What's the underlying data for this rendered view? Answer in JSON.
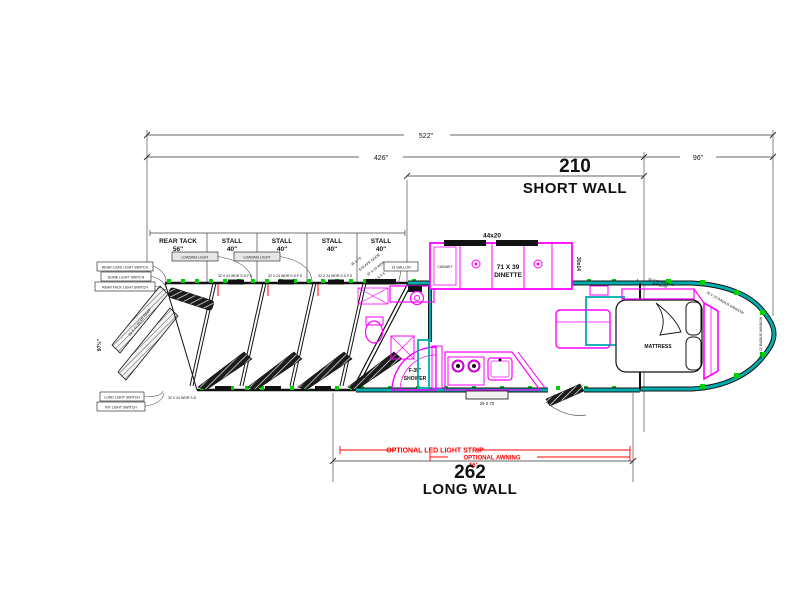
{
  "colors": {
    "line_black": "#111111",
    "furniture_magenta": "#ff00ff",
    "wall_teal": "#00adad",
    "marker_green": "#00d000",
    "option_red": "#ff0000"
  },
  "dimensions": {
    "overall": "522\"",
    "horse_section": "426\"",
    "gooseneck": "96\"",
    "short_wall": {
      "value": "210",
      "label": "SHORT WALL"
    },
    "long_wall": {
      "value": "262",
      "label": "LONG WALL"
    },
    "rear_height": "97½\""
  },
  "options": {
    "led_strip": "OPTIONAL LED LIGHT STRIP",
    "awning": "OPTIONAL AWNING",
    "awning_length": "16'"
  },
  "stall_header": {
    "columns": [
      {
        "label": "REAR TACK",
        "width": "56\""
      },
      {
        "label": "STALL",
        "width": "40\""
      },
      {
        "label": "STALL",
        "width": "40\""
      },
      {
        "label": "STALL",
        "width": "40\""
      },
      {
        "label": "STALL",
        "width": "40\""
      }
    ],
    "light_callout": "LOADING LIGHT"
  },
  "living_quarters": {
    "slide_size": "44x20",
    "dinette_line1": "71 X 39",
    "dinette_line2": "DINETTE",
    "slide_window": "30x14",
    "slide_cabinet": "CABINET",
    "water_tank": "13 GALLON",
    "shower_line1": "F-35\"",
    "shower_line2": "SHOWER",
    "closet": "CLOSET",
    "entry_step": "29 X 70",
    "mattress": "MATTRESS"
  },
  "annotations": {
    "stall_window": "32 X 24 WDR S.S.F.S",
    "rear_window": "32 X 24 WDR S.S.",
    "escape_door_1": "36 X 70",
    "escape_door_2": "ESCAPE DOOR",
    "escape_door_3": "32 X 24 WDR",
    "escape_door_4": "S.S.F.S",
    "radius_window_1": "26 X 22 RADIUS",
    "radius_window_2": "WINDOW",
    "nose_window": "26 X 22 RADIUS WINDOW",
    "ramp_note": "32 X 42 REAR RAMP",
    "callouts_top": [
      "REAR LOAD LIGHT SWITCH",
      "DOME LIGHT SWITCH",
      "REAR TACK LIGHT SWITCH"
    ],
    "callouts_bottom": [
      "LOAD LIGHT SWITCH",
      "INT LIGHT SWITCH"
    ]
  }
}
